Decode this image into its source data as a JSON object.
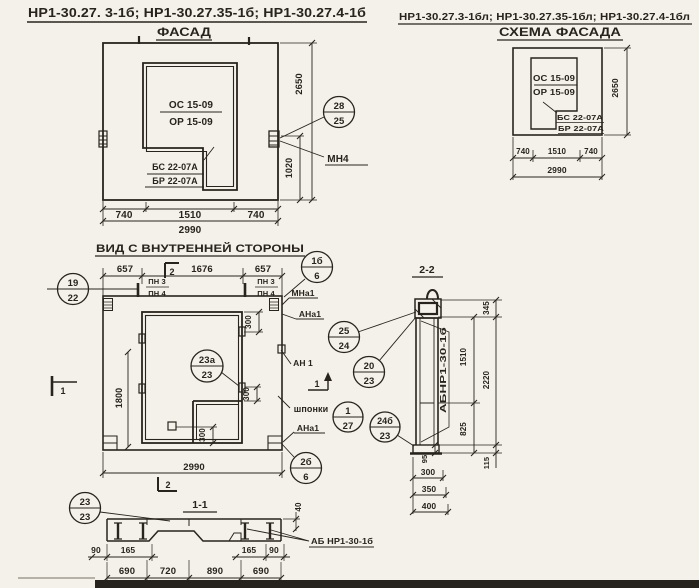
{
  "sheet": {
    "series_left": "НР1-30.27. 3-1б;  НР1-30.27.35-1б;  НР1-30.27.4-1б",
    "series_right": "НР1-30.27.3-1бл; НР1-30.27.35-1бл; НР1-30.27.4-1бл"
  },
  "facade": {
    "title": "ФАСАД",
    "opening_mark_top": "ОС 15-09",
    "opening_mark_bottom": "ОР 15-09",
    "block_mark_top": "БС 22-07А",
    "block_mark_bottom": "БР 22-07А",
    "anchor_label": "МН4",
    "dims": {
      "w1": "740",
      "w2": "1510",
      "w3": "740",
      "total": "2990",
      "height": "2650",
      "anchor_h": "1020"
    }
  },
  "schema": {
    "title": "СХЕМА ФАСАДА",
    "opening_mark_top": "ОС 15-09",
    "opening_mark_bottom": "ОР 15-09",
    "block_mark_top": "БС 22-07А",
    "block_mark_bottom": "БР 22-07А",
    "dims": {
      "w1": "740",
      "w2": "1510",
      "w3": "740",
      "total": "2990",
      "height": "2650"
    }
  },
  "inner_view": {
    "title": "ВИД С ВНУТРЕННЕЙ СТОРОНЫ",
    "labels": {
      "pn_top": "ПН 3",
      "pn_bottom": "ПН 4",
      "mna1": "МНа1",
      "ana1_top": "АНа1",
      "an1": "АН 1",
      "keys": "шпонки",
      "ana1_bottom": "АНа1"
    },
    "dims": {
      "top_left": "657",
      "top_mid": "1676",
      "top_right": "657",
      "total": "2990",
      "opening_h": "1800",
      "key1": "300",
      "key2": "300",
      "key3": "300"
    }
  },
  "section_2_2": {
    "title": "2-2",
    "panel_mark": "АБНР1-30-1б",
    "dims": {
      "d345": "345",
      "d1510": "1510",
      "d2220": "2220",
      "d825": "825",
      "d95": "95",
      "d115": "115",
      "d300": "300",
      "d350": "350",
      "d400": "400"
    }
  },
  "section_1_1": {
    "title": "1-1",
    "panel_mark": "АБ НР1-30-1б",
    "dims": {
      "d40": "40",
      "d90l": "90",
      "d165l": "165",
      "d165r": "165",
      "d90r": "90",
      "d690l": "690",
      "d720": "720",
      "d890": "890",
      "d690r": "690"
    }
  },
  "callouts": {
    "c28_25": {
      "top": "28",
      "bottom": "25"
    },
    "c19_22": {
      "top": "19",
      "bottom": "22"
    },
    "c1b_6": {
      "top": "1б",
      "bottom": "6"
    },
    "c25_24": {
      "top": "25",
      "bottom": "24"
    },
    "c23a_23": {
      "top": "23а",
      "bottom": "23"
    },
    "c20_23": {
      "top": "20",
      "bottom": "23"
    },
    "c1_27": {
      "top": "1",
      "bottom": "27"
    },
    "c24b_23": {
      "top": "24б",
      "bottom": "23"
    },
    "c2b_6": {
      "top": "2б",
      "bottom": "6"
    },
    "c23_23": {
      "top": "23",
      "bottom": "23"
    }
  },
  "section_markers": {
    "m1": "1",
    "m2": "2"
  }
}
